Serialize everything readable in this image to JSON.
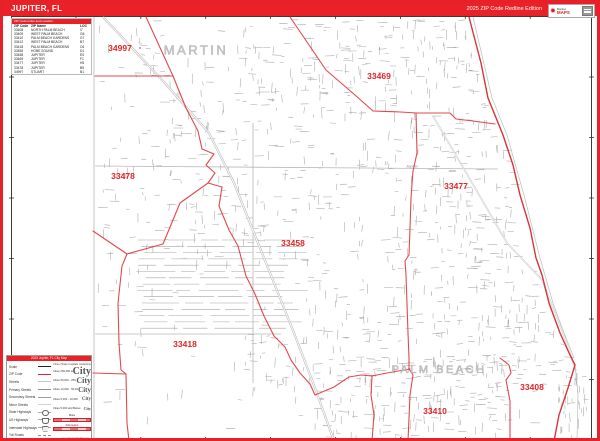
{
  "header": {
    "title": "JUPITER, FL",
    "edition": "2025 ZIP Code Redline Edition",
    "logo": {
      "brand_top": "Market",
      "brand_bottom": "MAPS"
    }
  },
  "zip_table": {
    "title": "ZIP Code Index and Location",
    "columns": {
      "zip": "ZIP Code",
      "name": "ZIP Name",
      "loc": "LOC"
    },
    "rows": [
      {
        "zip": "33408",
        "name": "NORTH PALM BEACH",
        "loc": "I7"
      },
      {
        "zip": "33409",
        "name": "WEST PALM BEACH",
        "loc": "G6"
      },
      {
        "zip": "33410",
        "name": "PALM BEACH GARDENS",
        "loc": "G7"
      },
      {
        "zip": "33412",
        "name": "WEST PALM BEACH",
        "loc": "B7"
      },
      {
        "zip": "33418",
        "name": "PALM BEACH GARDENS",
        "loc": "C6"
      },
      {
        "zip": "33455",
        "name": "HOBE SOUND",
        "loc": "D1"
      },
      {
        "zip": "33458",
        "name": "JUPITER",
        "loc": "E5"
      },
      {
        "zip": "33469",
        "name": "JUPITER",
        "loc": "F1"
      },
      {
        "zip": "33477",
        "name": "JUPITER",
        "loc": "H5"
      },
      {
        "zip": "33478",
        "name": "JUPITER",
        "loc": "B5"
      },
      {
        "zip": "34997",
        "name": "STUART",
        "loc": "B1"
      }
    ]
  },
  "map": {
    "zip_labels": [
      {
        "text": "34997",
        "x": 117,
        "y": 45
      },
      {
        "text": "33469",
        "x": 376,
        "y": 73
      },
      {
        "text": "33478",
        "x": 120,
        "y": 173
      },
      {
        "text": "33477",
        "x": 453,
        "y": 183
      },
      {
        "text": "33458",
        "x": 290,
        "y": 240
      },
      {
        "text": "33418",
        "x": 182,
        "y": 341
      },
      {
        "text": "33408",
        "x": 529,
        "y": 384
      },
      {
        "text": "33410",
        "x": 432,
        "y": 408
      }
    ],
    "place_labels": [
      {
        "text": "MARTIN",
        "x": 193,
        "y": 47,
        "size": 13
      },
      {
        "text": "PALM BEACH",
        "x": 436,
        "y": 367,
        "size": 11
      }
    ],
    "town_labels": [
      {
        "text": "Jupiter",
        "x": 409,
        "y": 163
      }
    ]
  },
  "legend": {
    "title": "2025 Jupiter, FL City Map",
    "items": [
      {
        "label": "Scale",
        "kind": "scale"
      },
      {
        "label": "ZIP Code",
        "kind": "zip"
      },
      {
        "label": "Streets",
        "kind": "street"
      },
      {
        "label": "Primary Streets",
        "kind": "primary"
      },
      {
        "label": "Secondary Streets",
        "kind": "secondary"
      },
      {
        "label": "Minor Streets",
        "kind": "minor"
      },
      {
        "label": "State Highways",
        "kind": "state"
      },
      {
        "label": "US Highways",
        "kind": "us"
      },
      {
        "label": "Interstate Highways",
        "kind": "interstate"
      },
      {
        "label": "Toll Roads",
        "kind": "toll"
      }
    ],
    "cities_note": "Cities (State Capitals Underlined)",
    "city_sizes": [
      {
        "label": "Cities 250,000 and Above",
        "sample": "City",
        "size": 10
      },
      {
        "label": "Cities 50,000 - 250,000",
        "sample": "City",
        "size": 8
      },
      {
        "label": "Cities 10,000 - 50,000",
        "sample": "City",
        "size": 7
      },
      {
        "label": "Cities 5,000 - 10,000",
        "sample": "City",
        "size": 5
      },
      {
        "label": "Cities 5,000 and Below",
        "sample": "City",
        "size": 4
      }
    ],
    "scalebars": [
      {
        "label": "Miles"
      },
      {
        "label": "Kilometers"
      }
    ],
    "copyright": "www.MarketMAPS.com"
  },
  "colors": {
    "accent_red": "#ea2127",
    "boundary_red": "#e0393e",
    "road_gray": "#b8b8b8"
  }
}
